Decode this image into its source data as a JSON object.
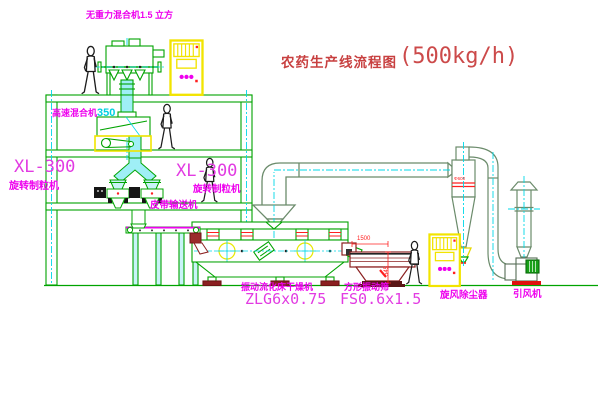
{
  "title": {
    "text": "农药生产线流程图",
    "capacity": "(500kg/h)"
  },
  "labels": {
    "gravity_mixer": "无重力混合机1.5 立方",
    "high_speed_mixer": "高速混合机",
    "high_speed_mixer_capacity": "350",
    "granulator_left_model": "XL-300",
    "granulator_left_name": "旋转制粒机",
    "granulator_right_model": "XL-300",
    "granulator_right_name": "旋转制粒机",
    "belt_conveyor": "皮带输送机",
    "fluid_bed_dryer": "振动流化床干燥机",
    "fluid_bed_dryer_model": "ZLG6x0.75",
    "vibrating_screen": "方形振动筛",
    "vibrating_screen_model": "FS0.6x1.5",
    "cyclone": "旋风除尘器",
    "induced_draft_fan": "引风机"
  },
  "dimensions": {
    "screen_length": "1500",
    "screen_height": "545",
    "cyclone_marking": "Φ600"
  },
  "colors": {
    "line_green": "#00A300",
    "duct_green": "#6B8B6B",
    "centerline_cyan": "#00D8E8",
    "pipe_fill_cyan": "#9FEFF6",
    "label_magenta": "#EE00EE",
    "title_red": "#C84040",
    "dimension_red": "#FF2020",
    "cabinet_yellow": "#F2E400",
    "screen_maroon": "#8B2020"
  }
}
